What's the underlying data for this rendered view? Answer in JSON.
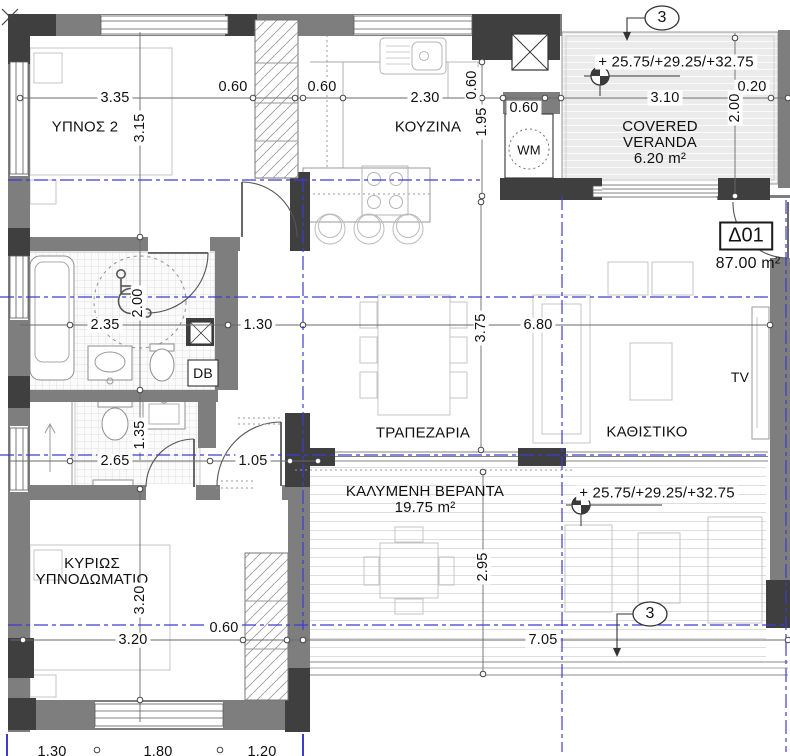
{
  "plan": {
    "unit_id": "Δ01",
    "unit_area": "87.00 m²",
    "rooms": {
      "bedroom2": "ΥΠΝΟΣ 2",
      "kitchen": "ΚΟΥΖΙΝΑ",
      "covered_veranda_en": "COVERED VERANDA",
      "covered_veranda_en_area": "6.20 m²",
      "dining": "ΤΡΑΠΕΖΑΡΙΑ",
      "living": "ΚΑΘΙΣΤΙΚΟ",
      "covered_veranda_gr": "ΚΑΛΥΜΕΝΗ ΒΕΡΑΝΤΑ",
      "covered_veranda_gr_area": "19.75 m²",
      "master_bedroom": "ΚΥΡΙΩΣ ΥΠΝΟΔΩΜΑΤΙΟ"
    },
    "equipment": {
      "wm": "WM",
      "db": "DB",
      "tv": "TV"
    },
    "levels": {
      "top": "+ 25.75/+29.25/+32.75",
      "bottom": "+ 25.75/+29.25/+32.75"
    },
    "section_marker": "3",
    "dims": {
      "bedroom2_width": "3.35",
      "bedroom2_depth": "3.15",
      "bedroom2_closet": "0.60",
      "kitchen_offset": "0.60",
      "kitchen_width": "2.30",
      "counter_depth": "0.60",
      "kitchen_depth": "1.95",
      "kitchen_door": "0.60",
      "veranda_top_width": "3.10",
      "veranda_top_edge": "0.20",
      "veranda_top_depth": "2.00",
      "bath1_width": "2.35",
      "bath1_depth": "2.00",
      "hall_width": "1.30",
      "living_width": "6.80",
      "living_depth": "3.75",
      "bath2_width": "2.65",
      "bath2_depth": "1.35",
      "master_door": "1.05",
      "master_width": "3.20",
      "master_depth": "3.20",
      "master_closet": "0.60",
      "veranda_bottom_width": "7.05",
      "veranda_bottom_depth": "2.95",
      "grid_a": "1.30",
      "grid_b": "1.80",
      "grid_c": "1.20"
    }
  },
  "colors": {
    "wall": "#7e7e7e",
    "column": "#3f3f3f",
    "axis_blue": "#3c3cd2",
    "deck": "#ebebeb",
    "tile_line": "#d8d8d8"
  }
}
